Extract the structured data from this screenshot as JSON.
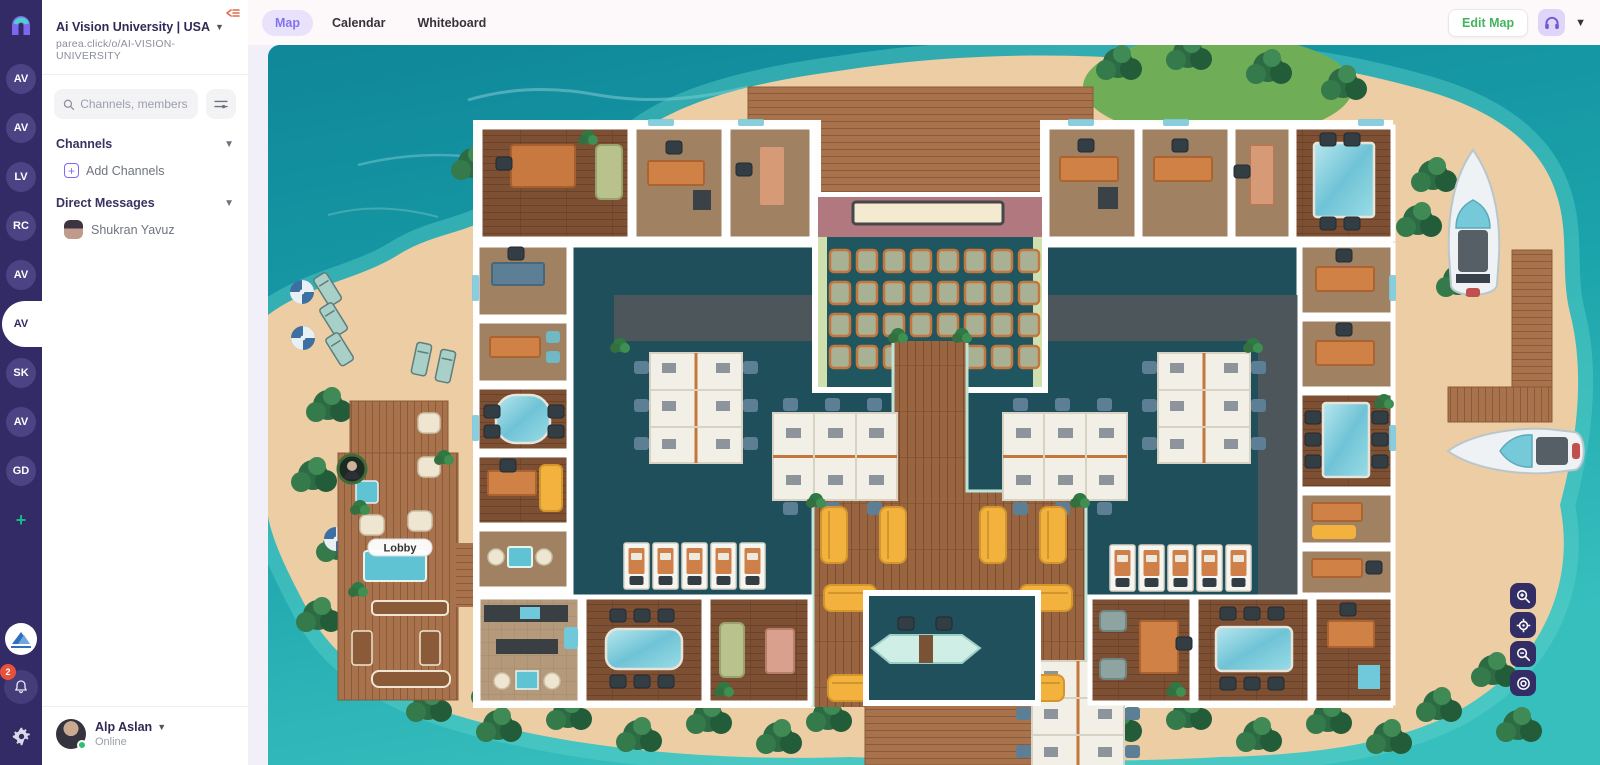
{
  "rail": {
    "workspaces": [
      {
        "initials": "AV"
      },
      {
        "initials": "AV"
      },
      {
        "initials": "LV"
      },
      {
        "initials": "RC"
      },
      {
        "initials": "AV"
      },
      {
        "initials": "AV"
      },
      {
        "initials": "SK"
      },
      {
        "initials": "AV"
      },
      {
        "initials": "GD"
      }
    ],
    "add_label": "+",
    "notification_count": "2"
  },
  "sidebar": {
    "org_name": "Ai Vision University | USA",
    "org_url": "parea.click/o/AI-VISION-UNIVERSITY",
    "search_placeholder": "Channels, members",
    "channels_label": "Channels",
    "add_channels_label": "Add Channels",
    "dm_label": "Direct Messages",
    "dm_items": [
      {
        "name": "Shukran Yavuz"
      }
    ],
    "user": {
      "name": "Alp Aslan",
      "status": "Online"
    }
  },
  "topbar": {
    "tabs": [
      {
        "label": "Map",
        "active": true
      },
      {
        "label": "Calendar"
      },
      {
        "label": "Whiteboard"
      }
    ],
    "edit_map_label": "Edit Map"
  },
  "map": {
    "lobby_label": "Lobby",
    "controls": [
      "zoom-in",
      "locate",
      "zoom-out",
      "recenter"
    ]
  },
  "colors": {
    "rail_bg": "#322b66",
    "accent_purple": "#7c6af0",
    "tab_active_bg": "#e8e2fb",
    "edit_map_green": "#43b35f",
    "notification_red": "#e8513d",
    "online_green": "#2fbf71",
    "ocean_teal": "#1b9aa6"
  }
}
